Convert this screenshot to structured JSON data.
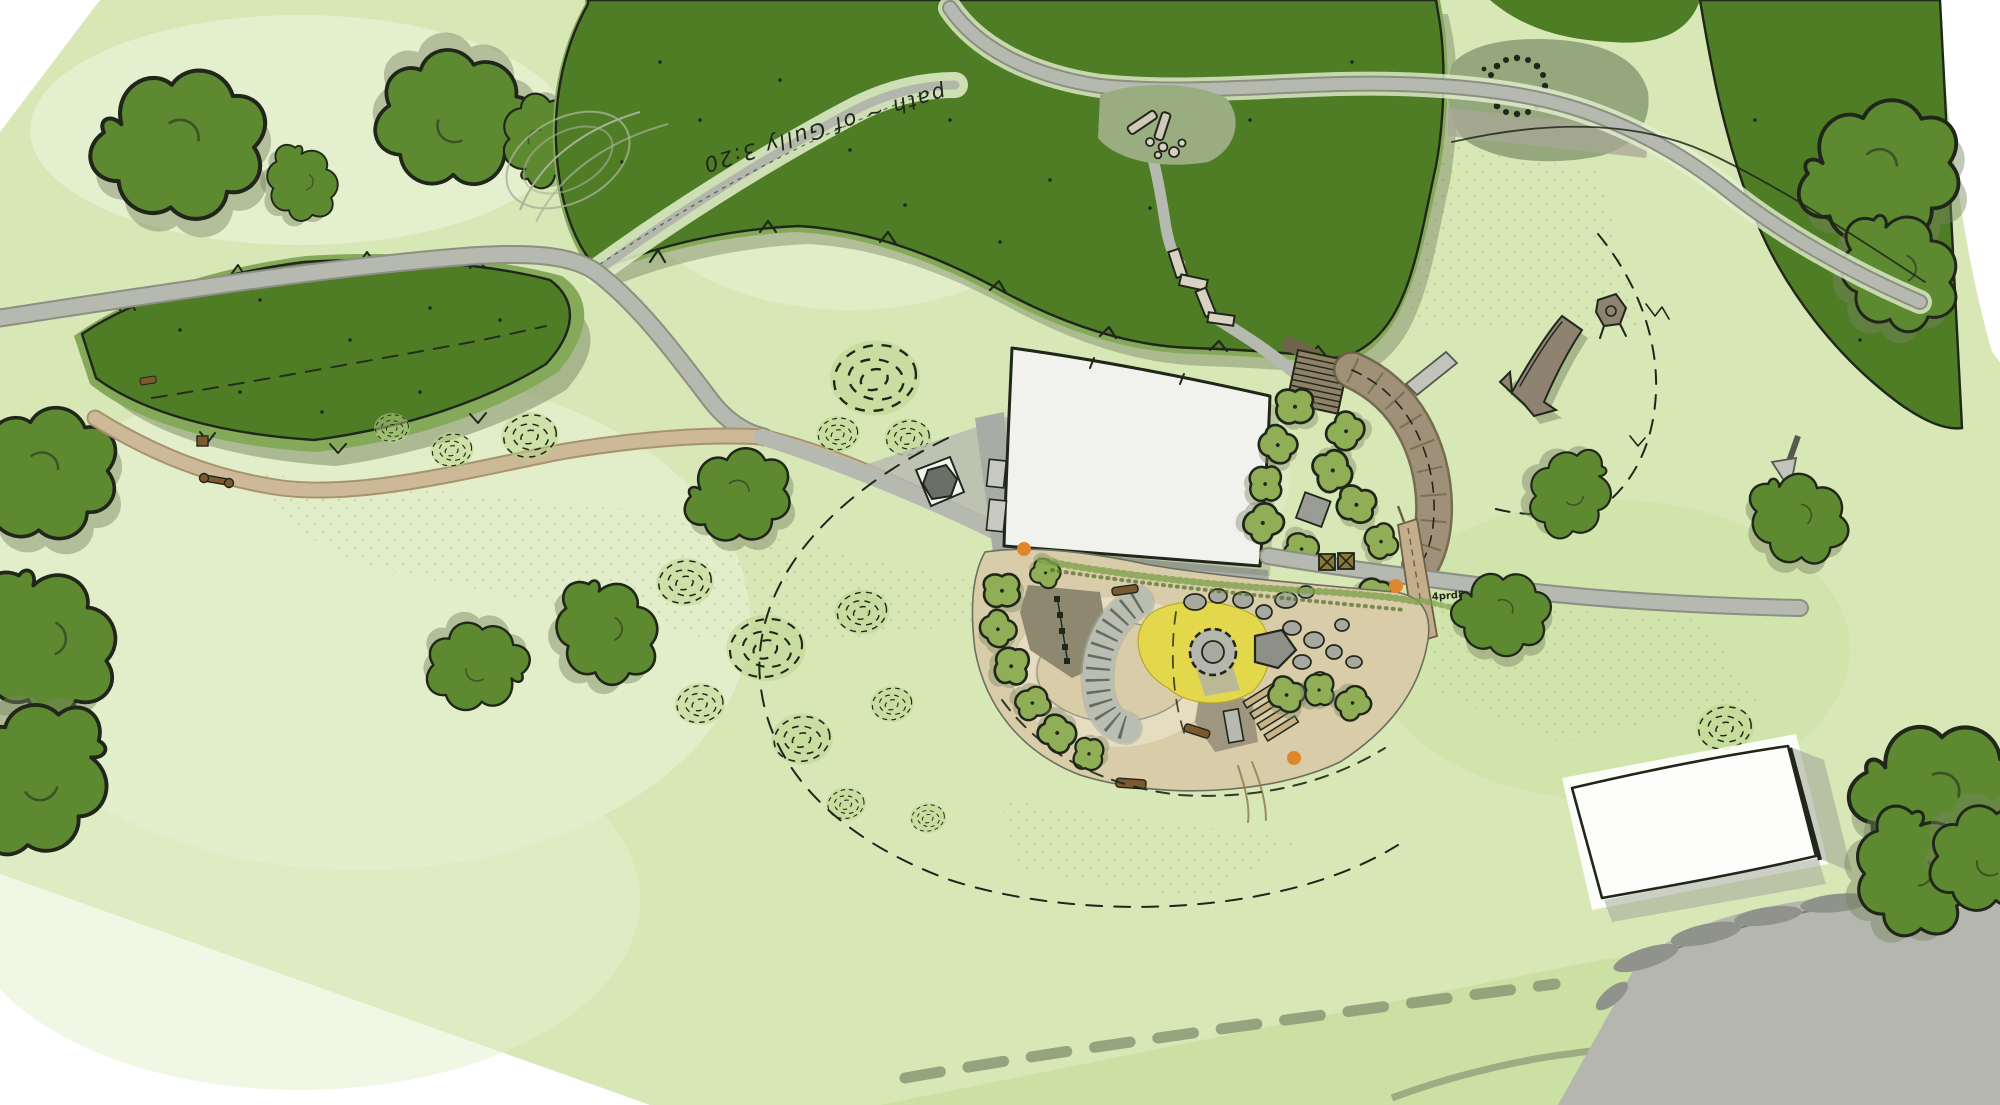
{
  "palette": {
    "paper": "#ffffff",
    "field": "#d7e7b6",
    "field_pale": "#e4f0cf",
    "field_dark": "#c9dfa0",
    "meadow_sage": "#95a87d",
    "woodland": "#4f7d26",
    "woodland_mid": "#84a958",
    "woodland_shadow": "#77855f",
    "tree": "#5d8931",
    "bush": "#8fae55",
    "shrub_ring": "#b9d48a",
    "path_grey": "#b6b9b0",
    "path_edge": "#8c8f82",
    "path_tan": "#cdb998",
    "path_tan_edge": "#a9936f",
    "terrace": "#9f9177",
    "boardwalk": "#8f8068",
    "play_base": "#d9cca9",
    "play_loop": "#e6dcc0",
    "mound": "#8f8871",
    "sand": "#e3d84b",
    "rock": "#a7a9a1",
    "rock_dark": "#8e9088",
    "timber": "#7a5a2e",
    "plank": "#c8b287",
    "building": "#f1f2ee",
    "apron": "#a9aca4",
    "road": "#b4b6af",
    "hedge": "#8f938b",
    "hedge_dash": "#8fa07b",
    "marker": "#e0862c",
    "pencil": "#a9b096",
    "ink": "#20261a"
  },
  "annotations": {
    "path_note": "path ~ of Gully 3:20",
    "small_label": "4prd8"
  },
  "markers": {
    "orange_dot_count": 3
  },
  "features": [
    "woodland-belt-top",
    "woodland-left",
    "stone-circle",
    "log-clearing",
    "zigzag-steps",
    "boardwalk-ramp",
    "terrace-walk",
    "visitor-building",
    "building-apron",
    "hexagon-pad",
    "play-area",
    "sand-pit",
    "fire-circle",
    "climbing-bank",
    "boulder-cluster",
    "timber-logs",
    "picnic-tables",
    "fallen-log",
    "tree-stump",
    "shrub-spirals",
    "barn-building",
    "road",
    "hedgerow"
  ]
}
